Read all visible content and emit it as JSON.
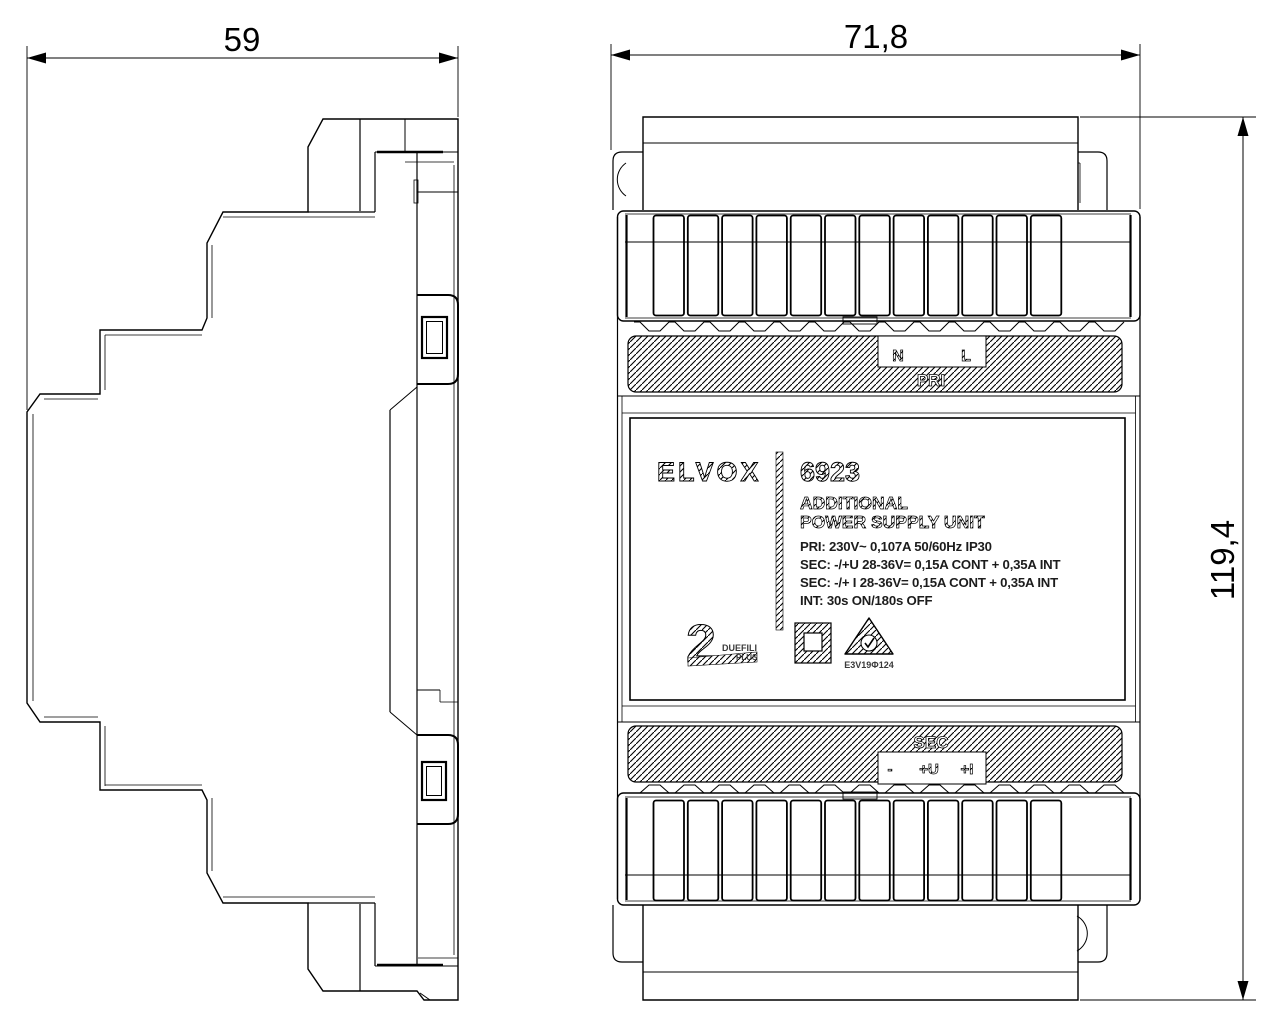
{
  "drawing": {
    "type": "technical-dimension-drawing",
    "colors": {
      "line": "#000000",
      "background": "#ffffff"
    },
    "views": {
      "side": {
        "width_dim": "59"
      },
      "front": {
        "width_dim": "71,8",
        "height_dim": "119,4",
        "pri": {
          "band": "PRI",
          "n": "N",
          "l": "L"
        },
        "sec": {
          "band": "SEC",
          "minus": "-",
          "plus_u": "+U",
          "plus_i": "+I"
        },
        "label": {
          "brand": "ELVOX",
          "model": "6923",
          "product_line1": "ADDITIONAL",
          "product_line2": "POWER SUPPLY UNIT",
          "spec_pri": "PRI: 230V~  0,107A  50/60Hz  IP30",
          "spec_sec1": "SEC: -/+U 28-36V= 0,15A CONT + 0,35A INT",
          "spec_sec2": "SEC: -/+ I 28-36V= 0,15A CONT + 0,35A INT",
          "spec_int": "INT: 30s ON/180s OFF",
          "system_number": "2",
          "system_line1": "DUEFILI",
          "system_line2": "PLUS",
          "cert_code": "E3V19Φ124"
        }
      }
    }
  }
}
